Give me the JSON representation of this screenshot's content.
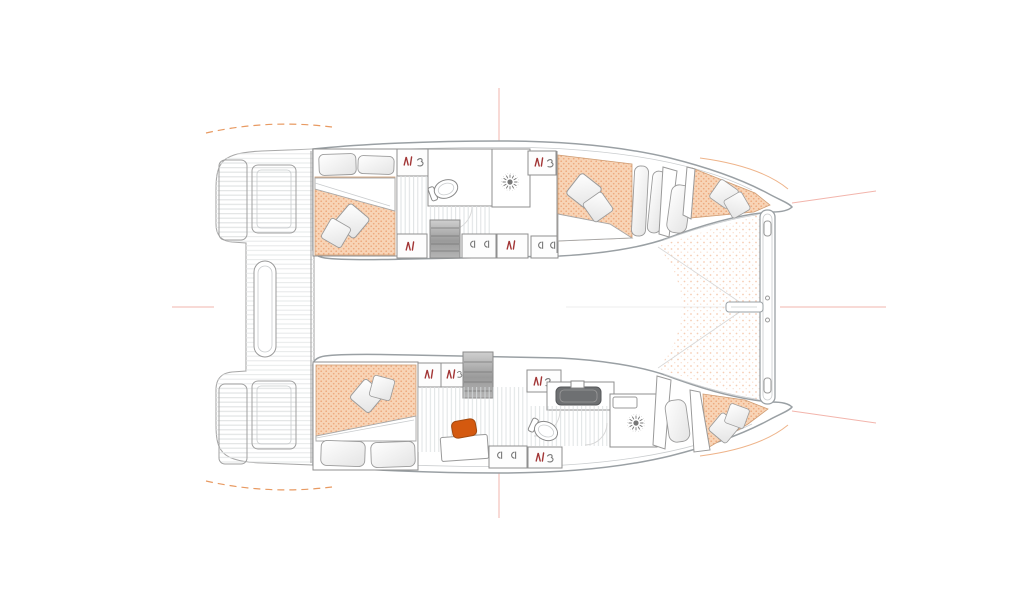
{
  "meta": {
    "type": "floorplan",
    "subject": "Catamaran yacht interior layout, plan view, bow to the right",
    "text_visible": false
  },
  "palette": {
    "canvas": "#ffffff",
    "hull-line": "#9aa0a4",
    "wall-line": "#8f8f8f",
    "detail-line": "#c9ccce",
    "floor-hatch": "#dadee0",
    "deck-hatch": "#e3e5e6",
    "mattress": "#f8d4b6",
    "mattress-dot": "#eda87c",
    "mattress-edge": "#cf9d74",
    "tramp-dot": "#f3c2a3",
    "accent": "#d4590f",
    "icon-red": "#a23535",
    "icon-gray": "#777777",
    "sink-dark": "#6e7072",
    "guide-pink": "#f2b4ac",
    "guide-orange": "#e89a62"
  },
  "legend": {
    "wardrobe_icon": "hanging-clothes",
    "shelf_icon": "shelf-curl",
    "drawer_icon": "drawer-pulls",
    "shower_icon": "shower-rose-starburst"
  },
  "hulls": {
    "port_top": {
      "aft_cabin": {
        "furniture": [
          "double-berth",
          "pillow",
          "pillow",
          "duvet",
          "cushion",
          "cushion"
        ],
        "storage": [
          "wardrobe",
          "shelves"
        ]
      },
      "midship": {
        "fixtures": [
          "washbasin",
          "toilet",
          "shower"
        ],
        "storage": [
          "cabinet",
          "wardrobe",
          "drawers",
          "wardrobe"
        ],
        "access": [
          "companionway-steps"
        ]
      },
      "forward_cabin": {
        "furniture": [
          "double-berth",
          "cushion",
          "cushion"
        ],
        "storage": [
          "wardrobe",
          "drawers"
        ]
      },
      "forepeak": {
        "furniture": [
          "berth",
          "pillow",
          "cushion",
          "cushion"
        ]
      }
    },
    "starboard_bottom": {
      "aft_cabin": {
        "furniture": [
          "double-berth",
          "pillow",
          "pillow",
          "duvet",
          "cushion",
          "cushion"
        ],
        "storage": [
          "wardrobe",
          "wardrobe"
        ]
      },
      "midship": {
        "fixtures": [
          "washbasin",
          "toilet",
          "shower",
          "shower-seat"
        ],
        "furniture": [
          "desk",
          "desk-chair"
        ],
        "storage": [
          "wardrobe",
          "drawers",
          "wardrobe"
        ],
        "access": [
          "companionway-steps"
        ]
      },
      "forepeak": {
        "furniture": [
          "berth",
          "pillow",
          "cushion",
          "cushion"
        ]
      }
    }
  },
  "deck": {
    "aft": [
      "port-swim-platform",
      "port-transom-steps",
      "cockpit-bench",
      "starboard-transom-steps",
      "starboard-swim-platform"
    ],
    "fore": [
      "trampoline",
      "forward-crossbeam",
      "bowsprit"
    ],
    "guides": [
      "centerline",
      "bow-guide-lines",
      "stern-guide-arcs"
    ]
  }
}
